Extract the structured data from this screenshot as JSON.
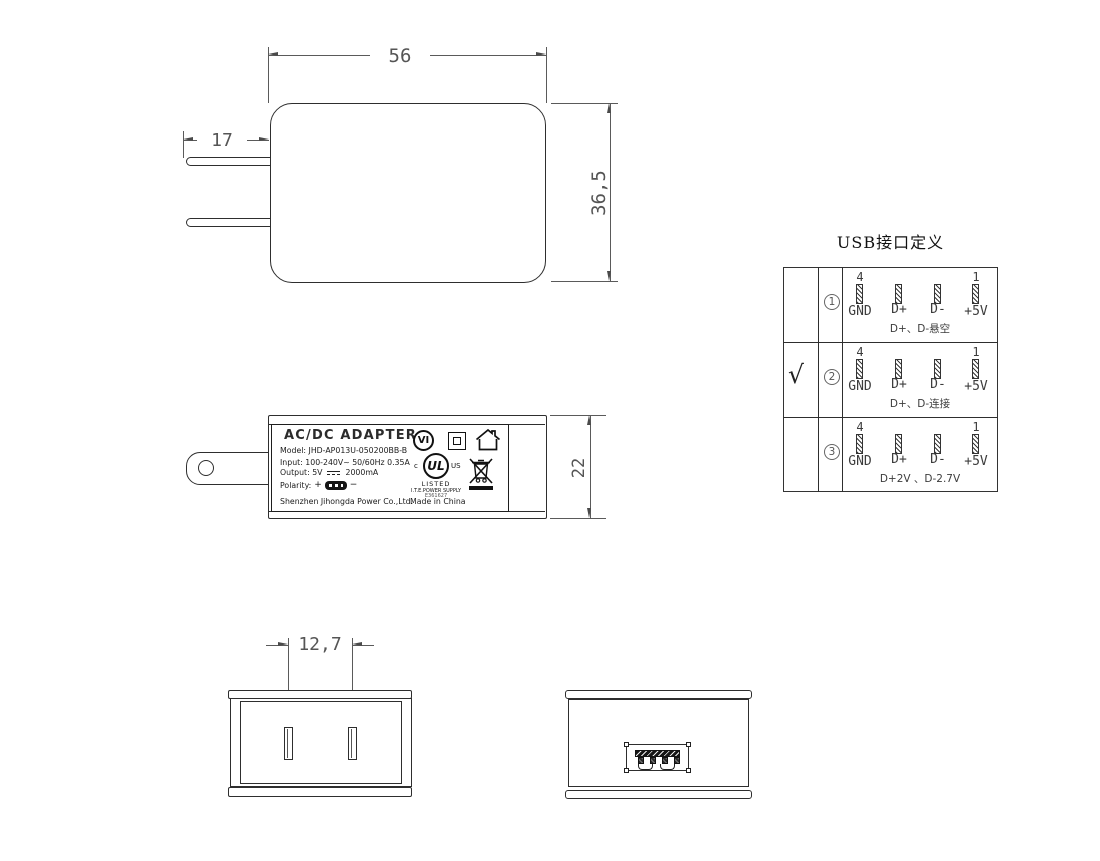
{
  "front_view": {
    "width_dim": "56",
    "prong_dim": "17",
    "height_dim": "36,5"
  },
  "side_view": {
    "height_dim": "22",
    "label": {
      "title": "AC/DC  ADAPTER",
      "model": "Model: JHD-AP013U-050200BB-B",
      "input": "Input: 100-240V~  50/60Hz  0.35A",
      "output_prefix": "Output: 5V",
      "output_suffix": "2000mA",
      "polarity_label": "Polarity:",
      "plus": "+",
      "minus": "−",
      "manufacturer": "Shenzhen Jihongda Power Co.,Ltd.",
      "made_in": "Made in China",
      "marks": {
        "efficiency": "VI",
        "ul_letters": "UL",
        "ul_c": "c",
        "ul_us": "US",
        "listed": "LISTED",
        "ite": "I.T.E.POWER SUPPLY",
        "file_no": "E361627"
      }
    }
  },
  "bottom_view": {
    "pitch_dim": "12,7"
  },
  "usb_table": {
    "title": "USB接口定义",
    "rows": [
      {
        "check": "",
        "num": "1",
        "pin_left_no": "4",
        "pin_right_no": "1",
        "pins": [
          "GND",
          "D+",
          "D-",
          "+5V"
        ],
        "note": "D+、D-悬空"
      },
      {
        "check": "√",
        "num": "2",
        "pin_left_no": "4",
        "pin_right_no": "1",
        "pins": [
          "GND",
          "D+",
          "D-",
          "+5V"
        ],
        "note": "D+、D-连接"
      },
      {
        "check": "",
        "num": "3",
        "pin_left_no": "4",
        "pin_right_no": "1",
        "pins": [
          "GND",
          "D+",
          "D-",
          "+5V"
        ],
        "note": "D+2V 、D-2.7V"
      }
    ]
  }
}
